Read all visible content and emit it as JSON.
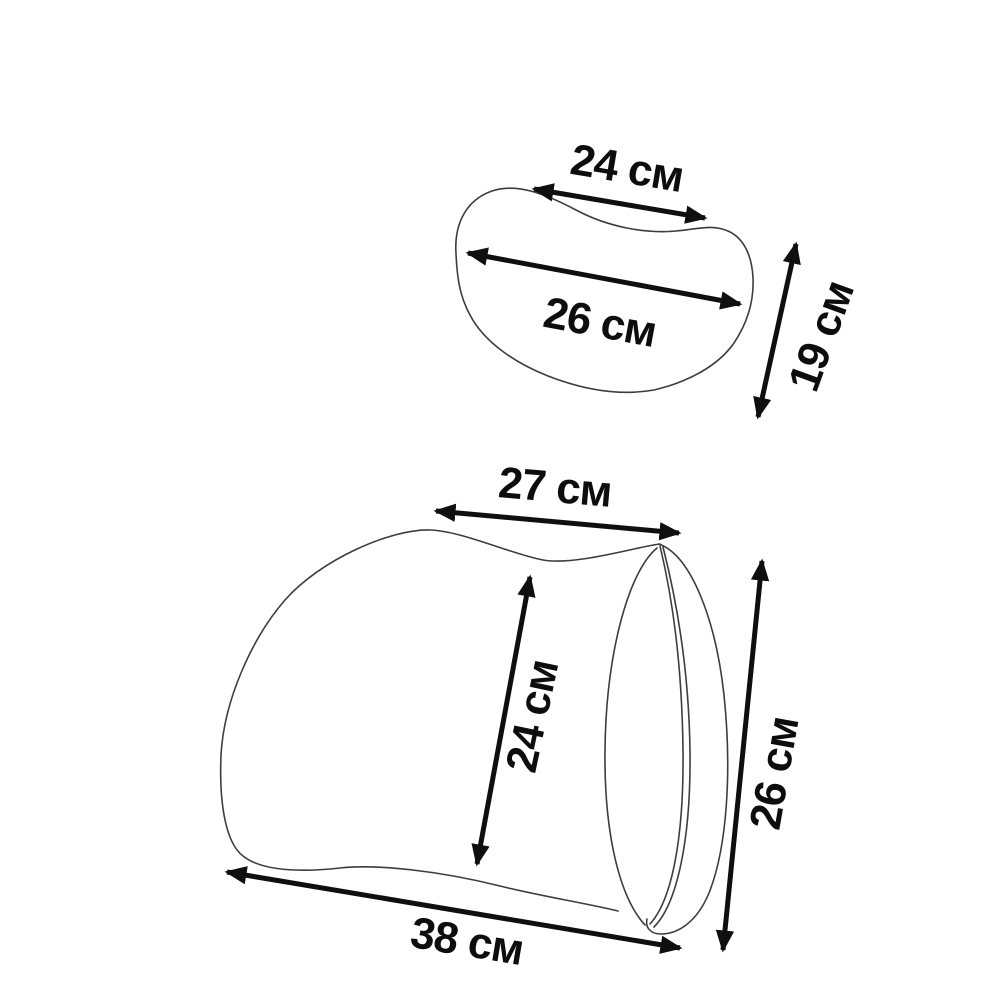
{
  "labels": {
    "headrest": {
      "top_width": "24 см",
      "full_width": "26 см",
      "height": "19 см"
    },
    "lumbar": {
      "top_width": "27 см",
      "front_height": "24 см",
      "side_height": "26 см",
      "bottom_width": "38 см"
    }
  },
  "colors": {
    "outline": "#3d3d3d",
    "dimension_lines": "#0f0f0f",
    "text": "#0d0d0d",
    "background": "#ffffff"
  }
}
